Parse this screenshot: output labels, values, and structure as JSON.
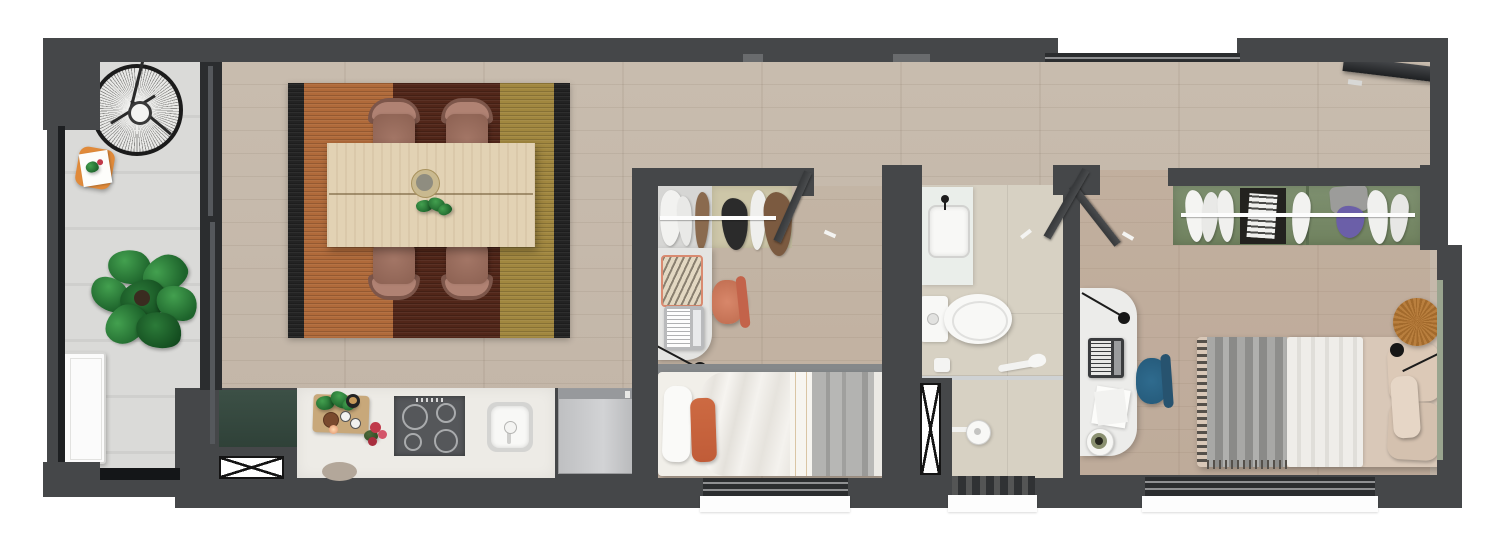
{
  "meta": {
    "image_kind": "top-down 3D rendered apartment floor plan",
    "apartment_layout": "long narrow unit: balcony, open living-dining with kitchen, bedroom 1, bathroom, bedroom 2 connected by a top corridor"
  },
  "colors": {
    "wall": "#454749",
    "wallDark": "#2b2d2f",
    "sill": "#fdfdfd",
    "wood": "#c8bcae",
    "wood2tint": "rgba(176,138,108,0.22)",
    "bed1tint": "rgba(176,138,108,0.10)",
    "balcony": "#dadad8",
    "tile": "#d7d1c3",
    "counter": "#edebe6",
    "cooktop": "#55575a",
    "fridge": "#c5c6c8",
    "cabinetGreen": "#3c5046",
    "wardrobeGreen": "#7e9070",
    "wardrobeBeige": "#cdc6a8",
    "desk": "#e4e4e2",
    "fixture": "#f8f8f6",
    "rugOrange": "#b06a3a",
    "rugMaroon": "#512619",
    "rugGold": "#a1873f",
    "rugBlack": "#232323",
    "tableWood": "#e2d2b4",
    "chairMauve": "#a37666",
    "chairCoral": "#d8876a",
    "chairTeal": "#2f6b8e",
    "bedWhite": "#f1efe9",
    "bedGray": "#a9a9a7",
    "cushionOrange": "#c05c38",
    "bed2Beige": "#d9c8b8",
    "throwGray": "#9b9b99",
    "plantGreen": "#2e7d3a",
    "trayOrange": "#e08a3a",
    "tableRound": "#b97f3e",
    "glass": "#55585c"
  },
  "rooms": {
    "balcony": {
      "label": "Balcony",
      "furniture": [
        "round wire lounge chair",
        "orange tray table with magazine",
        "monstera plant",
        "white storage cabinet"
      ]
    },
    "living_dining": {
      "label": "Living / Dining room",
      "furniture": [
        "striped rug (orange, maroon, gold, black borders)",
        "wood dining table with centre bowl and plant",
        "4 mauve dining chairs",
        "sliding glass door to balcony"
      ]
    },
    "kitchen": {
      "label": "Kitchen",
      "furniture": [
        "dark green base cabinet",
        "white countertop with cutting board and herbs",
        "4-burner cooktop",
        "sink",
        "refrigerator",
        "stool",
        "x-marked window"
      ]
    },
    "bedroom_1": {
      "label": "Bedroom 1",
      "furniture": [
        "open wardrobe with hanging clothes",
        "desk with laptop and patterned mat",
        "coral desk chair",
        "black wall lamp",
        "single bed with white duvet, grey blankets and orange cushion",
        "entry door",
        "window"
      ]
    },
    "bathroom": {
      "label": "Bathroom",
      "furniture": [
        "vanity with basin and black tap",
        "toilet",
        "glass shower divider with hand shower",
        "round rain shower head",
        "x-marked window",
        "entry door"
      ]
    },
    "bedroom_2": {
      "label": "Bedroom 2",
      "furniture": [
        "green open wardrobe with clothes and shelf box",
        "desk with laptop, papers and round speaker",
        "teal desk chair",
        "black wall lamps",
        "bed with grey fringed throw, white quilt and beige pillows",
        "round wooden side table",
        "leaning mirror",
        "entry door",
        "window"
      ]
    }
  },
  "legend": {
    "walls": "dark charcoal",
    "windows": "white sills / x-marked panes",
    "doors": "angled dark leaves with white handles"
  }
}
